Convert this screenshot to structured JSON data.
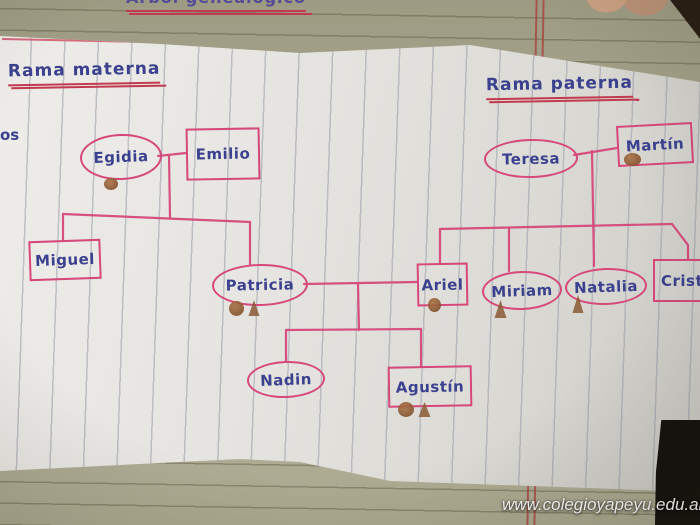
{
  "title_partial": "Árbol genealógico",
  "fragments": {
    "left_edge_text": "os"
  },
  "branches": {
    "maternal": {
      "label": "Rama materna"
    },
    "paternal": {
      "label": "Rama paterna"
    }
  },
  "nodes": {
    "egidia": {
      "label": "Egidia",
      "shape": "oval"
    },
    "emilio": {
      "label": "Emilio",
      "shape": "rect"
    },
    "miguel": {
      "label": "Miguel",
      "shape": "rect"
    },
    "patricia": {
      "label": "Patricia",
      "shape": "oval"
    },
    "teresa": {
      "label": "Teresa",
      "shape": "oval"
    },
    "martin": {
      "label": "Martín",
      "shape": "rect"
    },
    "ariel": {
      "label": "Ariel",
      "shape": "rect"
    },
    "miriam": {
      "label": "Miriam",
      "shape": "oval"
    },
    "natalia": {
      "label": "Natalia",
      "shape": "oval"
    },
    "cristian": {
      "label": "Cristian",
      "shape": "rect"
    },
    "nadin": {
      "label": "Nadin",
      "shape": "oval"
    },
    "agustin": {
      "label": "Agustín",
      "shape": "rect"
    }
  },
  "watermark": "www.colegioyapeyu.edu.ar",
  "colors": {
    "ink_blue": "#3a418e",
    "ink_pink": "#d6487a",
    "underline_red": "#c23a50",
    "stain_brown": "#8a5a34",
    "notebook_paper": "#a9a690",
    "sheet_paper": "#e6e4e0"
  }
}
